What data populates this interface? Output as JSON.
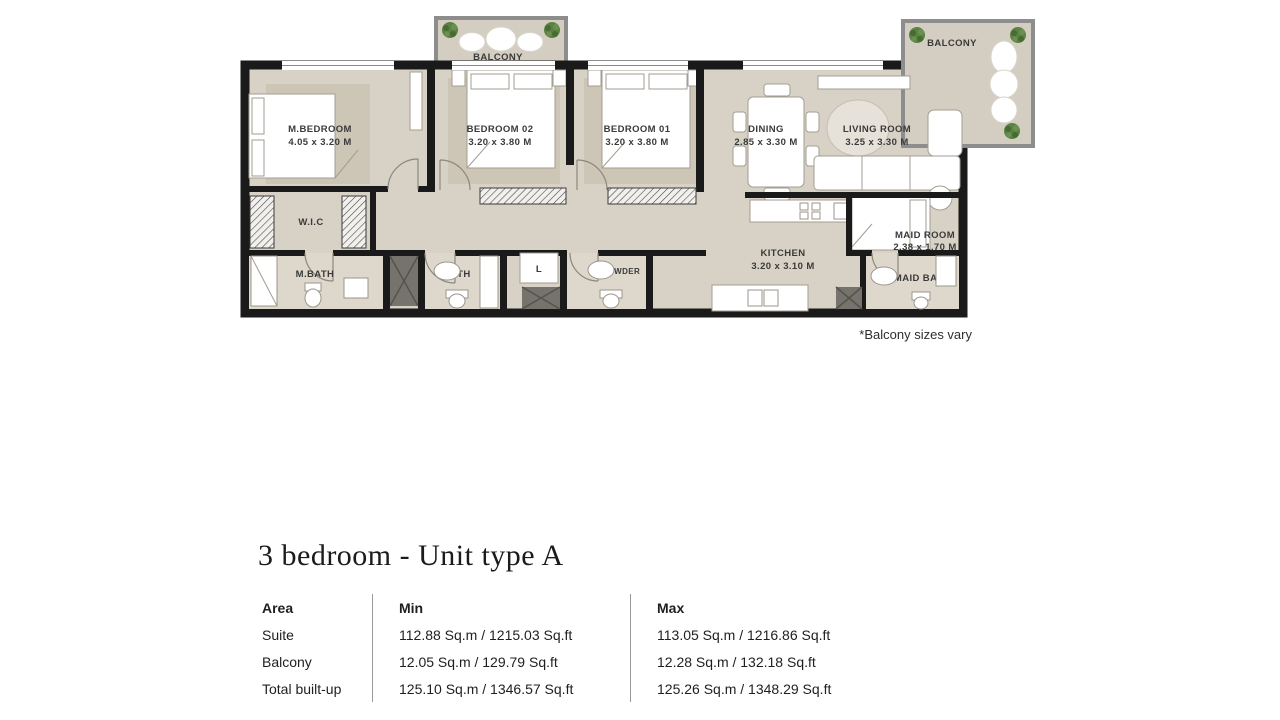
{
  "plan": {
    "note": "*Balcony sizes vary",
    "rooms": {
      "m_bedroom": {
        "name": "M.BEDROOM",
        "dims": "4.05 x 3.20 M"
      },
      "bedroom_02": {
        "name": "BEDROOM 02",
        "dims": "3.20 x 3.80 M"
      },
      "bedroom_01": {
        "name": "BEDROOM 01",
        "dims": "3.20 x 3.80 M"
      },
      "dining": {
        "name": "DINING",
        "dims": "2.85 x 3.30 M"
      },
      "living_room": {
        "name": "LIVING ROOM",
        "dims": "3.25 x 3.30 M"
      },
      "kitchen": {
        "name": "KITCHEN",
        "dims": "3.20 x 3.10 M"
      },
      "maid_room": {
        "name": "MAID ROOM",
        "dims": "2.38 x 1.70 M"
      },
      "wic": {
        "name": "W.I.C"
      },
      "m_bath": {
        "name": "M.BATH"
      },
      "bath": {
        "name": "BATH"
      },
      "laundry": {
        "name": "L"
      },
      "powder": {
        "name": "POWDER"
      },
      "maid_bath": {
        "name": "MAID BATH"
      },
      "balcony_left": {
        "name": "BALCONY"
      },
      "balcony_right": {
        "name": "BALCONY"
      }
    }
  },
  "unit": {
    "title": "3 bedroom - Unit type A",
    "table": {
      "headers": [
        "Area",
        "Min",
        "Max"
      ],
      "rows": [
        {
          "area": "Suite",
          "min": "112.88 Sq.m / 1215.03 Sq.ft",
          "max": "113.05 Sq.m / 1216.86 Sq.ft"
        },
        {
          "area": "Balcony",
          "min": "12.05 Sq.m / 129.79 Sq.ft",
          "max": "12.28 Sq.m / 132.18 Sq.ft"
        },
        {
          "area": "Total built-up",
          "min": "125.10 Sq.m / 1346.57 Sq.ft",
          "max": "125.26 Sq.m / 1348.29 Sq.ft"
        }
      ]
    }
  },
  "colors": {
    "wall": "#1a1a1a",
    "floor": "#d8d2c6",
    "rug": "#cdc5b5",
    "balcony-floor": "#d4cec2",
    "balcony-border": "#8d8d8d",
    "shaft": "#75736c",
    "plant": "#5c8144",
    "label": "#3a3a3a",
    "text": "#1f1f1f",
    "divider": "#9a9a9a"
  }
}
